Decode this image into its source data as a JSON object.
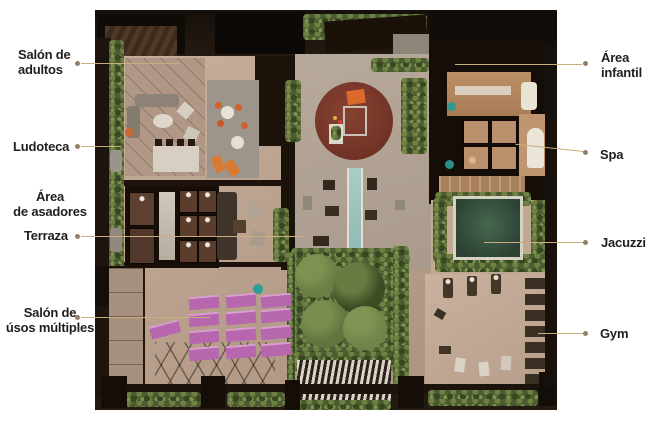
{
  "labels": {
    "left": [
      {
        "id": "salon-de-adultos",
        "lines": [
          "Salón de",
          "adultos"
        ]
      },
      {
        "id": "ludoteca",
        "lines": [
          "Ludoteca"
        ]
      },
      {
        "id": "area-de-asadores",
        "lines": [
          "Área",
          "de asadores"
        ]
      },
      {
        "id": "terraza",
        "lines": [
          "Terraza"
        ]
      },
      {
        "id": "salon-de-usos-multiples",
        "lines": [
          "Salón de",
          "úsos múltiples"
        ]
      }
    ],
    "right": [
      {
        "id": "area-infantil",
        "lines": [
          "Área",
          "infantil"
        ]
      },
      {
        "id": "spa",
        "lines": [
          "Spa"
        ]
      },
      {
        "id": "jacuzzi",
        "lines": [
          "Jacuzzi"
        ]
      },
      {
        "id": "gym",
        "lines": [
          "Gym"
        ]
      }
    ]
  },
  "palette": {
    "background": "#ffffff",
    "label_text": "#221e1b",
    "leader_line": "#c9ad7c",
    "leader_dot": "#94806a",
    "walls_dark": "#1d140e",
    "floor_beige": "#c3aa97",
    "plaza_gray": "#b0a396",
    "hedge_green": "#4c5c31",
    "kids_circle_red": "#7c3a2e",
    "lap_pool_blue": "#9fc6c0",
    "jacuzzi_green": "#35523f",
    "yoga_mat_purple": "#b767ae",
    "accent_orange": "#d2622b",
    "accent_teal": "#2d9e96"
  }
}
